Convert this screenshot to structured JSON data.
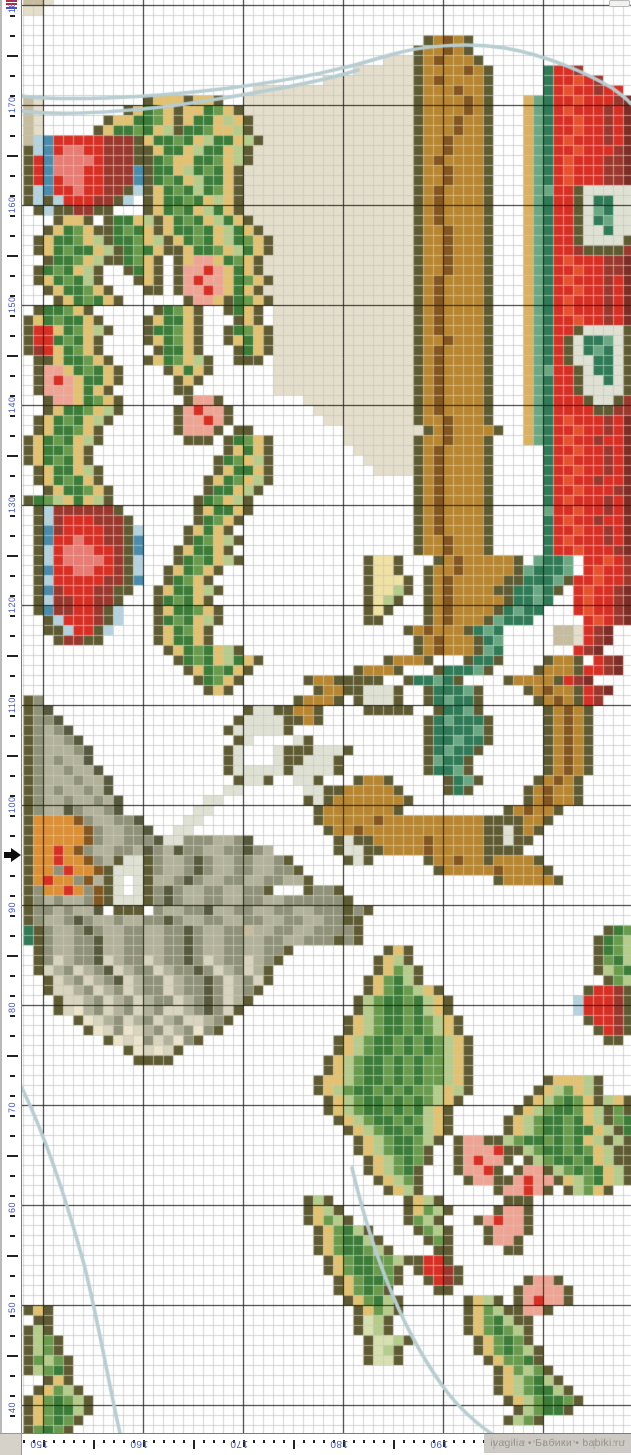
{
  "watermark": {
    "text": "ivagilia • Бабики • babiki.ru"
  },
  "rulers": {
    "number_color": "#4153c8",
    "tick_color": "#222222",
    "left": {
      "labels": [
        {
          "text": "180",
          "y": 5
        },
        {
          "text": "170",
          "y": 105
        },
        {
          "text": "160",
          "y": 205
        },
        {
          "text": "150",
          "y": 305
        },
        {
          "text": "140",
          "y": 405
        },
        {
          "text": "130",
          "y": 505
        },
        {
          "text": "120",
          "y": 605
        },
        {
          "text": "110",
          "y": 705
        },
        {
          "text": "100",
          "y": 805
        },
        {
          "text": "90",
          "y": 905
        },
        {
          "text": "80",
          "y": 1005
        },
        {
          "text": "70",
          "y": 1105
        },
        {
          "text": "60",
          "y": 1205
        },
        {
          "text": "50",
          "y": 1305
        },
        {
          "text": "40",
          "y": 1405
        }
      ],
      "tick_step": 20,
      "long_tick_offset": 55,
      "arrow_y": 855,
      "overlap_marker": {
        "red": "#cc2424",
        "blue": "#4153c8"
      }
    },
    "bottom": {
      "labels": [
        {
          "text": "150",
          "x": 43
        },
        {
          "text": "160",
          "x": 143
        },
        {
          "text": "170",
          "x": 243
        },
        {
          "text": "180",
          "x": 343
        },
        {
          "text": "190",
          "x": 443
        }
      ],
      "tick_step": 10,
      "mid_tick_offset": 93
    }
  },
  "chart": {
    "cols": 61,
    "rows": 144,
    "cell": 10,
    "offset_x": 1,
    "offset_y": -5,
    "grid": {
      "light": "rgba(198,198,198,0.75)",
      "dark": "#1f1f1f",
      "dark_off_x": 21,
      "dark_off_y": 5
    },
    "backstitch": {
      "color": "#b6cdd2",
      "width": 3.5,
      "paths": [
        "M0,96 C38,101 118,99 208,88 C278,79 323,69 368,55 C398,46 443,42 483,48 C523,55 563,72 590,88 C600,95 606,100 609,104",
        "M0,111 C38,116 118,113 208,97 C248,90 298,82 336,70",
        "M0,1088 C30,1150 50,1220 63,1268 C78,1330 88,1390 98,1433",
        "M330,1168 C350,1252 380,1332 425,1392 C445,1417 465,1432 490,1447"
      ]
    },
    "palette": {
      ".": "#ffffff",
      "O": "#5e5b33",
      "G": "#3b7c38",
      "g": "#699b4c",
      "l": "#b5cc8b",
      "p": "#d7e1b0",
      "Y": "#e2c271",
      "y": "#efe2a2",
      "R": "#d92f23",
      "V": "#e8512d",
      "r": "#9a382e",
      "Q": "#e87c72",
      "P": "#efa493",
      "B": "#4a8cab",
      "b": "#b4d3de",
      "T": "#2f7a57",
      "t": "#6aa884",
      "C": "#dfe2d3",
      "N": "#835620",
      "n": "#b8862f",
      "c": "#ddb05f",
      "o": "#dd8f33",
      "K": "#c6bc9e",
      "k": "#e4decb",
      "D": "#57593d",
      "d": "#8f9278",
      "e": "#b2b29a",
      "f": "#d9d4bd",
      "F": "#ece4cb",
      "M": "#7c2d26"
    },
    "pixels": [
      "KKk..........................................................",
      "kk...........................................................",
      ".............................................................",
      ".............................................................",
      "........................................OnNnO................",
      ".......................................OnnNnO................",
      "....................................kkkOnNnnnO...............",
      ".................................kkkkkkOnnnnNnO.....TRRr.....",
      "..............................kkkkkkkkkOnNnnnnO.....TRRVRr...",
      ".......................kkkkkkkkkkkkkkkkOnnnNnnO.....TRVRRrRR.",
      "Kk..........OYYYOYYO..kkkkkkkkkkkkkkkkkOnnnnNnO...ctTRRVRRRrM",
      "Kk........OYGgYOYYGgYOkkkkkkkkkkkkkkkkkOnnnnNnO...ctTRVRRRrRM",
      "Kk......OYYGGgYOYGGYlYOkkkkkkkkkkkkkkkkOnnnNnnO...ctTRRVRRrRM",
      "Kk.....OYGGgGYlOGGgYYlOkkkkkkkkkkkkkkkkOnnnNnnO...ctTRRVRRrRM",
      "KbBRRRRRrrrOYGGgGYlGGYlOkkkkkkkkkkkkkkkOnnNnnnO...ctTRVRRRrRM",
      "ObBRQQRRrrrOOYGGYlGGYlOkkkkkkkkkkkkkkkkOnnNnnnO...ctTRRVRRRrM",
      "ORBQQQQRrrrOOGgYYGGgYlOkkkkkkkkkkkkkkkkOnNnnnnO...ctTRVRRRrrM",
      "ORBQQQRRrrrBOGGYlGgGYOkkkkkkkkkkkkkkkkkOnnNnnnO...ctTRVRRRrrM",
      "ORBRQQRRrrrBOGgGYlGGYOkkkkkkkkkkkkkkkkkOnnNnnnO...ctTRVRRRrrM",
      "ObBRRQRRrrObOYGgGlGgYOkkkkkkkkkkkkkkkkkOnNnnnnO...cttRROCCCCC",
      "ObObRRRrrOb.OYGGgGYlYOkkkkkkkkkkkkkkkkkOnNnnnnO...ctTRROCTTCC",
      ".ObOOrrOO...OYGgGYlGYOkkkkkkkkkkkkkkkkkOnNnnnnO...ctTRROCtTCC",
      "...OYYO.OGGYlOYGgGYlGYOkkkkkkkkkkkkkkkkOnNnnnnO...ctTRROCTtCC",
      "..OYGgYOOGgGYOYGGgGYlGYOkkkkkkkkkkkkkkkOnnNnnnO...ctTRROCCTCC",
      ".OYGGgYlOGGgYlOYGgGYlGgYOkkkkkkkkkkkkkkOnnNnnnO...ctTRROCCCCO",
      ".OYGgGGYlOGgGYOOYGGgYlGYOkkkkkkkkkkkkkkOnnNnnnO...ctTRRrOOOOr",
      "..OGGgYlOOGgYO.OYPPYGgYOkkkkkkkkkkkkkkkOnnNnnnO...ctTRVRRRrrM",
      ".OGgGYlO..OGYO.OPPRPYGYOkkkkkkkkkkkkkkkOnnNnnnO...ctTRRVRRrrM",
      ".OYGgGlO...OYO.OPRPPYGgYOkkkkkkkkkkkkkkOnNnnnnO...ctTRVRRRrRM",
      "..OYGGgYO...OO.OPPRPYGYOkkkkkkkkkkkkkkkOnNnnnnO...ctTRRVRRrRM",
      "...OYGgGYO......OPPYOGgYOkkkkkkkkkkkkkkOnNnnnnO...ctTRVRRRrRM",
      ".OGGgYO......OGgYO..OGYO.kkkkkkkkkkkkkkOnNnnnnO...ctTRVRRRrRM",
      "OYGgGGYO....OYGGYO...OYO.kkkkkkkkkkkkkkOnNnnnnO...ctTRRVRRrRM",
      "ORRYGgYlO...OGGgYO..OGgYOkkkkkkkkkkkkkkOnNnnnnO...ctTRROCCCCO",
      "ORRGgGYO....OYGgYO..OYGYOkkkkkkkkkkkkkkOnnNnnnO...ctTROCTTtCO",
      "OrRYGgYO.....OGGYO...OGYOkkkkkkkkkkkkkkOnNnnnnO...ctTROCTtTCO",
      ".OOYGGgYO...OYGgYlO..OOO.kkkkkkkkkkkkkkOnNnnnnO...ctTROCCTTCO",
      ".OPPYGgGYO....OYGYO......kkkkkkkkkkkkkkOnNnnnnO...cttRROCTTCO",
      ".OPRPYGGYO.....OYO.......kkkkkkkkkkkkkkOnNnnnnO...ctTRROCCTCO",
      ".OPPPYGYO......OO........kkkkkkkkkkkkkkOnNnnnnO...ctTRROCCCCO",
      "..OPPYGgYO......OPPO........kkkkkkkkkkkOnNnnnnO...ctTRRROCCOr",
      "..OYGGgYlO.....OPRPPO........kkkkkkkkkkOnNnnnnO...ctTRRRROOrr",
      ".OYGgGYlO......OPPRPO.........kkkkkkkkkOnnNnnnO...ctTRVRRRrRM",
      ".OYGGgYO.......OPPPO.OO.........kkkkkkkkOnNnnnnO..ctTRRVRRrRM",
      "OYGgGYlO........OOO.OGgYO.......kkkkkkkOnnNnnnO...ctTRVRRrRRM",
      "OYGGgYO.............OYGYO........kkkkkkOnNnnnnO.....TRRVRRrRM",
      "OYGgGYO............OGgYlO.........kkkkkOnNnnnnO.....TRVRRRrRM",
      ".OYGGYlO...........OYGGYO..........kkkkOnNnnnnO.....TRRVRRrRM",
      ".OYGgGYO..........OYGgYlO..............OnNnnnnO.....TRVRRrRRM",
      "..OYGGgYO.........OGGYlO...............OnNnnnnO.....TRRVRRRrM",
      "OGglYGYlO........OGgYlO................OnNnnnnO.....TRVRRRrRM",
      ".ObrrrrrrO.......OYGGYO................OnNnnnnO.....tRRVRRrRM",
      ".ObrRRRrrrO......OGgYO.................OnNnnnnO.....TRVRRrRRM",
      ".OBrRRRRrrOb....OYGYO..................OnNnnnnO.....TRRVRRrRM",
      ".OBRRQRRrrOB....OGgYlO.................OnnNnnnO.....TRVRRRrRM",
      ".ObRQQQRRrOB...OYGGYO..................OnnNnnnO.....TRRVRRRrM",
      ".ObRQQQQRrOb...OGgGYlO............OyyO...OnNnnnnnO.tTTt.RRVRr",
      ".OBRRQQRRrOb..OYGgYO..............OyyO..OnnNnnnnnOtTTTt.RVRRr",
      ".ObRRRRRrrOB..OGgYO...............OyyyO.OnNnnnnnOOTTTtORRVRRr",
      ".OBrRRRrrOO..OYGGYlO..............OyylO.OnNnnnnOOTTtTO.RVRRrM",
      ".ObrrRRrrO...OGgGYO...............OylO..OnNnnnnnOTTtT..RVRRrM",
      ".OBrrRRrOb...OYGGgYO..............OyO...OnNnnnnOTtTT...RVRRrM",
      "..ObRRRrOb...OGgGYlO..............OO....OnNnnnOtTTT.....RVRrM",
      "..OObRROb....OYGgYO...................OnNnnnOTtT.....KKkRrM..",
      "...OrrOO.....OYGGYO....................OnNnnnOTt.....KKkRrM..",
      "..............OYGgGYlO.................OnNnnnOtT.......RrM...",
      "...............OGgGYlGYO............OnnnO...OTTO....OnnO.RrM.",
      "................OYGgGYO..........OnnnO...OTTTtO....OnnnORRrM.",
      ".................OGgYO......OnnOOOOO..OTTtTO....OnnnnORrM....",
      "..................OYO........OnnOOCCCO..OTTTtO....OnNnnORrM..",
      "Od.........................OnnnO.OCCCO..OTtTTO.....OnNnORr...",
      "OdD...................OCCOOnnO....OOOOO..OTTtO......OnNnO....",
      "OddD.................OCCCCOOnO..........OTtTTTO.....OnNnO....",
      "OdedD...............OCCCCCO.............OTTTTtO.....OnNnO....",
      "OdeedD...............OC....CO...........OTTtTTO.....OnNnO....",
      "OdeeedD.............OC...COOOCCCO.......OTtTTO......OnNnO....",
      "OdedeeD.............OC...COOCCCO........OtTTO.......OnNnO....",
      "OdeedeeD............OCCCCCOCCCCO........OTTtO.......OnNnO....",
      "OdeeedeeD............OCCO..CCO...OnnO.....OTtO.....OnNnO.....",
      "OdedeedeD...........CC......CCOOnnnnnO....OTO.....OnNnnO.....",
      "OdeedeedeD........CC........OCOnnnnnnnO...........OnNnnO.....",
      "OdeeDdeedD.......CC..........OnnnnnnnO..........OnNnnO.......",
      "OooooNdeeddD....CC...........OnnnnnNnnnnnnnnnnOOOOnnO........",
      "OoooooNdeeddD..CC.............OnnNnnnnnnnnnnnnOOCOnO.........",
      "OoooooNdeedddDCCdddeedD........OCOOnnnnnNnnnnnOOCOO..........",
      "OooRoNdeeddeDdeDddeeddDde......OCCOOnnnnNnnnnnOOOO...........",
      "OooRooNdeOCCOdeedDdeeddeedO.....OCO.....OnnNnnOnnnnO.........",
      "OoodRooNOCCCOdeedDdeeddeeddO.............OnnnnnNnnnnO........",
      "OoRoodNeOC.COeedDdeeddeeddeeO..................OnnnnnO.......",
      "OdooRodNOC.COdDdeeddeeddO...OddO.............................",
      "OdedeedNOCCCOdDdeeddeeddeeddddddO............................",
      "OddedeeD.OOO.deeddDeeddeeddeedddOdO..........................",
      "OdeedDdeedeeddDdeeddeeddeeddeeddOO...........................",
      "TOdeedDdeeddeeddDdeeddKeeddeeddddO........................OGg",
      "TOdeeddDeeddeeddDdeeddeeddeedddOdO.......................OGgl",
      ".OdeeddDeeddeeddDdeeddeeddO.........OYO..................OGgl",
      ".OdfeddDfeddfeddDdfeddfedO.........OYlO..................OgGl",
      ".OfedfedDfeddfeddDdfedfeO..........OYglO.................OlgG",
      "..OfedfedDfeddfeddDdfedfO.........OYgGlO..................Ogl",
      "..OffedfedfeddfeddDdfedO..........OYgGglYO..............ORRrO",
      "...OffedfedfeddfedDdfeO..........OlgGGgGlYO............bRRRrO",
      "...OfFedfedfedffedDdfO...........OlgGGgGlYO............bRRRrO",
      ".....OFfedfedfedffedO...........OYlgGGgGglYO............ORRrO",
      "......OFfdFfedfedFdO............OYlgGGgGglYO.............ORrO",
      "........OFfFdfeFdO.............OYlgGGgGgGglYO.............OO.",
      "..........OFfFfO...............OYlgGGgGgGglYO................",
      "...........OOOO...............OYlgGGgGgGgglYO................",
      "..............................OYlgGGgGgGgglYO................",
      ".............................OYYlgGGgGgGgglYO.......OYYYlO...",
      ".............................OYlgGGgGgGgglYlO......OYlgYlO...",
      "..............................OYlgGGgGgGglYO......OYlgGgYOlYO",
      "..............................OYlgGGgGgGlYO......OYlgGGgYlOgO",
      "...............................OYlgGGgGglYO.....OYlgGGgGYlOgG",
      "................................OYlgGGgGlYO.....OYlgGGgGGYlOG",
      ".................................OYlgGGglO.OPPOOlgGGgGgGYlOlO",
      ".................................OYlgGGgO..OPPPROOlgGGgGgYlOO",
      "..................................OYlgGgO..OPRPPO.OlgGGgGYlOO",
      "..................................OYlgGO...OPPRO.OPPOlgGgGYlO",
      "...................................OYlgO....OPPOOPRPPOYlgGYlO",
      "....................................OYlO.......OPPRPO.OlgYO..",
      "............................OlO.......OYlO......OOO..........",
      "............................OYlO......OYglO....OPPO..........",
      "............................OYglO.....OglO...OPRPPO.........",
      ".............................OYgGlO....OglO...OPPPO..........",
      ".............................OYgGGlO....OgO...OPPO...........",
      ".............................OYgGGglO....OO.....OO...........",
      "..............................OYgGGgglOORRO..................",
      "..............................OYgGGggO.ORRrO.................",
      "...............................OYgGGgO..ORrO......OPPO.......",
      "...............................OYgGgO....OO......OPPPPO......",
      "................................OYgGlO......OYlO.OPRPPO......",
      "OYO..............................OYglO......OYglOOPPO........",
      ".OO..............................OplO.......OYgGlOO..........",
      "OlO..............................OplO.......OYgGglO..........",
      "OlgO..............................OpplO......OYgGgO..........",
      "OlgO..............................OplO.......OYgGglO.........",
      "OglgO.............................OppO........OYggGO.........",
      "OlgGO..........................................OYglgO........",
      "..OYO..........................................OYlgGlO.......",
      ".OYglO.........................................OYlgGGlO......",
      "OYgGglO.........................................OYlgGGgO.....",
      "OYgGGlO..........................................OlgGGO......",
      "OYgGgO..........................................OlgO.........",
      "OgGgO........................................................"
    ]
  }
}
